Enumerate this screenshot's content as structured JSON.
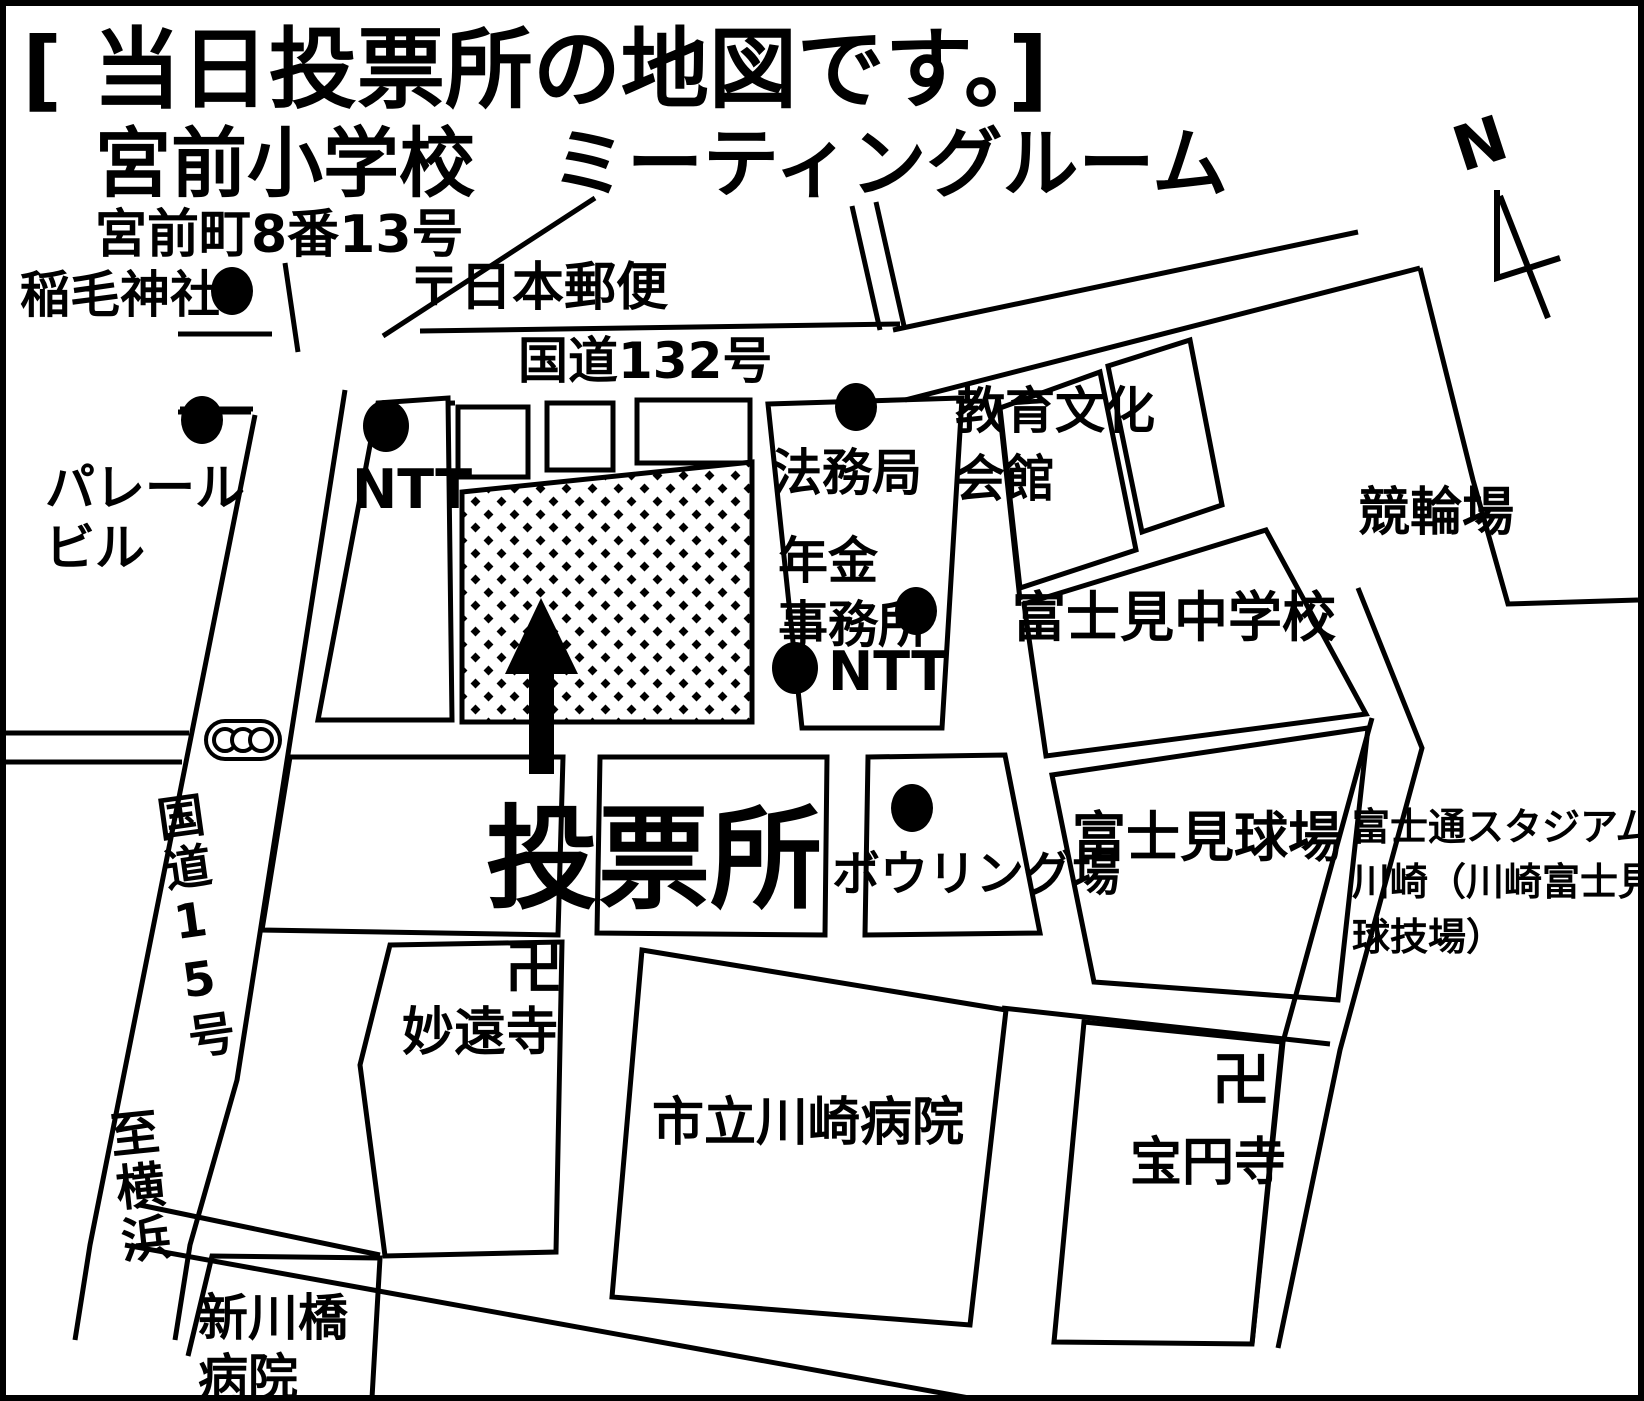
{
  "colors": {
    "background": "#ffffff",
    "ink": "#000000"
  },
  "header": {
    "line1": "[ 当日投票所の地図です。]",
    "line2": "宮前小学校　ミーティングルーム",
    "line3": "宮前町8番13号"
  },
  "map": {
    "compass_label": "N",
    "polling_label": "投票所",
    "temple_mark": "卍",
    "roads": {
      "route132": "国道132号",
      "route15": "国道15号",
      "to_yokohama": "至横浜"
    },
    "landmarks": {
      "inage_shrine": "稲毛神社",
      "japan_post": "〒日本郵便",
      "parele_line1": "パレール",
      "parele_line2": "ビル",
      "ntt_west": "NTT",
      "legal_affairs": "法務局",
      "pension_line1": "年金",
      "pension_line2": "事務所",
      "ntt_east": "NTT",
      "education_hall_line1": "教育文化",
      "education_hall_line2": "会館",
      "keirin_track": "競輪場",
      "fujimi_junior_high": "富士見中学校",
      "fujimi_ballpark": "富士見球場",
      "fujitsu_line1": "富士通スタジアム",
      "fujitsu_line2": "川崎（川崎富士見",
      "fujitsu_line3": "球技場）",
      "bowling_alley": "ボウリング場",
      "myoenji_temple": "妙遠寺",
      "kawasaki_hospital": "市立川崎病院",
      "hoenji_temple": "宝円寺",
      "shinkawabashi_line1": "新川橋",
      "shinkawabashi_line2": "病院"
    }
  }
}
